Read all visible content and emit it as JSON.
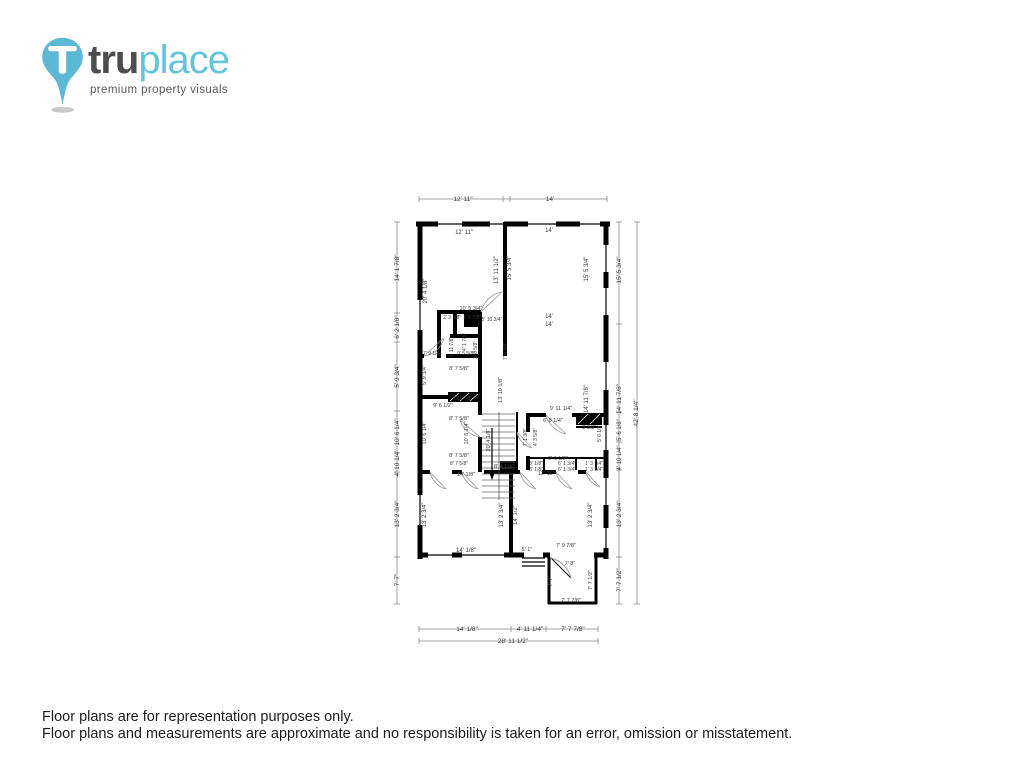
{
  "logo": {
    "brand_bold": "tru",
    "brand_light": "place",
    "tagline": "premium property visuals",
    "pin_color": "#5cb8d5",
    "text_dark": "#4d4d4f",
    "text_light": "#66c3dc"
  },
  "footer": {
    "line1": "Floor plans are for representation purposes only.",
    "line2": "Floor plans and measurements are approximate and no responsibility is taken for an error, omission or misstatement."
  },
  "floorplan": {
    "wall_color": "#000000",
    "dimline_color": "#777777",
    "overall_width": "28' 11 1/2\"",
    "overall_height": "42' 8 1/4\"",
    "labels": [
      {
        "t": "12' 11\"",
        "x": 463,
        "y": 201,
        "r": 0,
        "s": 6.5
      },
      {
        "t": "14'",
        "x": 550,
        "y": 201,
        "r": 0,
        "s": 6.5
      },
      {
        "t": "12' 11\"",
        "x": 464,
        "y": 234,
        "r": 0,
        "s": 6
      },
      {
        "t": "14'",
        "x": 549,
        "y": 232,
        "r": 0,
        "s": 6
      },
      {
        "t": "14' 1 7/8\"",
        "x": 399,
        "y": 268,
        "r": -90,
        "s": 6.5
      },
      {
        "t": "6' 2 1/8\"",
        "x": 399,
        "y": 327,
        "r": -90,
        "s": 6.5
      },
      {
        "t": "5' 9 3/4\"",
        "x": 399,
        "y": 376,
        "r": -90,
        "s": 6.5
      },
      {
        "t": "10' 6 1/4\"",
        "x": 399,
        "y": 432,
        "r": -90,
        "s": 6.5
      },
      {
        "t": "4' 10 1/4\"",
        "x": 399,
        "y": 463,
        "r": -90,
        "s": 6.5
      },
      {
        "t": "13' 2 3/4\"",
        "x": 399,
        "y": 514,
        "r": -90,
        "s": 6.5
      },
      {
        "t": "7' 7\"",
        "x": 399,
        "y": 580,
        "r": -90,
        "s": 6.5
      },
      {
        "t": "20' 4 1/8\"",
        "x": 427,
        "y": 291,
        "r": -90,
        "s": 6
      },
      {
        "t": "13' 11 1/2\"",
        "x": 498,
        "y": 270,
        "r": -90,
        "s": 6
      },
      {
        "t": "15' 5 3/4\"",
        "x": 511,
        "y": 268,
        "r": -90,
        "s": 6
      },
      {
        "t": "15' 5 3/4\"",
        "x": 588,
        "y": 269,
        "r": -90,
        "s": 6
      },
      {
        "t": "15' 5 3/4\"",
        "x": 621,
        "y": 270,
        "r": -90,
        "s": 6.5
      },
      {
        "t": "42' 8 1/4\"",
        "x": 638,
        "y": 413,
        "r": -90,
        "s": 6.5
      },
      {
        "t": "14'",
        "x": 549,
        "y": 318,
        "r": 0,
        "s": 6
      },
      {
        "t": "14'",
        "x": 549,
        "y": 326,
        "r": 0,
        "s": 6
      },
      {
        "t": "14' 11 7/8\"",
        "x": 588,
        "y": 399,
        "r": -90,
        "s": 6
      },
      {
        "t": "14' 11 7/8\"",
        "x": 621,
        "y": 399,
        "r": -90,
        "s": 6.5
      },
      {
        "t": "10' 5 3/4\"",
        "x": 471,
        "y": 310,
        "r": 0,
        "s": 5.5
      },
      {
        "t": "2' 3 3/8\"",
        "x": 452,
        "y": 319,
        "r": 0,
        "s": 5
      },
      {
        "t": "1' 5 7/8\"",
        "x": 472,
        "y": 319,
        "r": 0,
        "s": 5
      },
      {
        "t": "5' 10 3/4\"",
        "x": 492,
        "y": 321,
        "r": 0,
        "s": 5
      },
      {
        "t": "6' 4 5/8\"",
        "x": 441,
        "y": 347,
        "r": -90,
        "s": 5
      },
      {
        "t": "3' 11 7/8\"",
        "x": 453,
        "y": 347,
        "r": -90,
        "s": 5
      },
      {
        "t": "4' 1 7/8\"",
        "x": 466,
        "y": 342,
        "r": -90,
        "s": 5
      },
      {
        "t": "3' 8 5/8\"",
        "x": 477,
        "y": 350,
        "r": -90,
        "s": 5
      },
      {
        "t": "7' 8 5/8\"",
        "x": 507,
        "y": 351,
        "r": -90,
        "s": 5
      },
      {
        "t": "7' 9 1/4\"",
        "x": 432,
        "y": 355,
        "r": 0,
        "s": 5
      },
      {
        "t": "9' 5 5/8\"",
        "x": 466,
        "y": 355,
        "r": 0,
        "s": 5
      },
      {
        "t": "8' 7 5/8\"",
        "x": 459,
        "y": 370,
        "r": 0,
        "s": 5.5
      },
      {
        "t": "5' 9 3/4\"",
        "x": 426,
        "y": 375,
        "r": -90,
        "s": 5.5
      },
      {
        "t": "13' 10 1/8\"",
        "x": 502,
        "y": 390,
        "r": -90,
        "s": 5.5
      },
      {
        "t": "2' 11 7/8\"",
        "x": 462,
        "y": 400,
        "r": 0,
        "s": 5
      },
      {
        "t": "9' 6 1/2\"",
        "x": 443,
        "y": 407,
        "r": 0,
        "s": 5.5
      },
      {
        "t": "8' 7 5/8\"",
        "x": 459,
        "y": 420,
        "r": 0,
        "s": 5.5
      },
      {
        "t": "10' 6 1/4\"",
        "x": 426,
        "y": 433,
        "r": -90,
        "s": 5.5
      },
      {
        "t": "10' 6 1/4\"",
        "x": 468,
        "y": 433,
        "r": -90,
        "s": 5.5
      },
      {
        "t": "20' 4 1/8\"",
        "x": 490,
        "y": 440,
        "r": -90,
        "s": 5.5
      },
      {
        "t": "8' 7 5/8\"",
        "x": 459,
        "y": 457,
        "r": 0,
        "s": 5.5
      },
      {
        "t": "8' 7 5/8\"",
        "x": 459,
        "y": 465,
        "r": 0,
        "s": 5
      },
      {
        "t": "14' 1/8\"",
        "x": 466,
        "y": 476,
        "r": 0,
        "s": 5.5
      },
      {
        "t": "8' 4 1/4\"",
        "x": 504,
        "y": 468,
        "r": 0,
        "s": 5.5
      },
      {
        "t": "12' 11\"",
        "x": 546,
        "y": 475,
        "r": 0,
        "s": 5.5
      },
      {
        "t": "9' 11 1/4\"",
        "x": 561,
        "y": 410,
        "r": 0,
        "s": 5.5
      },
      {
        "t": "6' 8 1/4\"",
        "x": 553,
        "y": 422,
        "r": 0,
        "s": 5.5
      },
      {
        "t": "3' 3/8\"",
        "x": 589,
        "y": 429,
        "r": 0,
        "s": 5
      },
      {
        "t": "7' 1 3/8\"",
        "x": 527,
        "y": 437,
        "r": -90,
        "s": 5
      },
      {
        "t": "4' 3 5/8\"",
        "x": 537,
        "y": 437,
        "r": -90,
        "s": 5
      },
      {
        "t": "5' 6 1/8\"",
        "x": 601,
        "y": 433,
        "r": -90,
        "s": 5
      },
      {
        "t": "9' 6 1/2\"",
        "x": 558,
        "y": 460,
        "r": 0,
        "s": 5.5
      },
      {
        "t": "3' 1/8\"",
        "x": 536,
        "y": 465,
        "r": 0,
        "s": 5
      },
      {
        "t": "3' 1/8\"",
        "x": 536,
        "y": 471,
        "r": 0,
        "s": 5
      },
      {
        "t": "6' 1 3/4\"",
        "x": 567,
        "y": 465,
        "r": 0,
        "s": 5
      },
      {
        "t": "6' 1 3/4\"",
        "x": 567,
        "y": 471,
        "r": 0,
        "s": 5
      },
      {
        "t": "1' 3 1/4\"",
        "x": 594,
        "y": 465,
        "r": 0,
        "s": 5
      },
      {
        "t": "1' 3 1/4\"",
        "x": 594,
        "y": 471,
        "r": 0,
        "s": 5
      },
      {
        "t": "5' 6 1/8\"",
        "x": 621,
        "y": 430,
        "r": -90,
        "s": 6
      },
      {
        "t": "4' 10 1/4\"",
        "x": 621,
        "y": 458,
        "r": -90,
        "s": 6
      },
      {
        "t": "13' 2 3/4\"",
        "x": 621,
        "y": 514,
        "r": -90,
        "s": 6.5
      },
      {
        "t": "7' 7 1/2\"",
        "x": 621,
        "y": 580,
        "r": -90,
        "s": 6.5
      },
      {
        "t": "13' 2 3/4\"",
        "x": 426,
        "y": 515,
        "r": -90,
        "s": 6
      },
      {
        "t": "13' 2 3/4\"",
        "x": 503,
        "y": 515,
        "r": -90,
        "s": 6
      },
      {
        "t": "14' 1/2\"",
        "x": 517,
        "y": 515,
        "r": -90,
        "s": 6
      },
      {
        "t": "13' 2 3/4\"",
        "x": 592,
        "y": 515,
        "r": -90,
        "s": 6
      },
      {
        "t": "14' 1/8\"",
        "x": 466,
        "y": 552,
        "r": 0,
        "s": 6
      },
      {
        "t": "5' 1\"",
        "x": 527,
        "y": 551,
        "r": 0,
        "s": 5.5
      },
      {
        "t": "7' 9 7/8\"",
        "x": 566,
        "y": 547,
        "r": 0,
        "s": 5.5
      },
      {
        "t": "7' 8\"",
        "x": 570,
        "y": 565,
        "r": 0,
        "s": 5.5
      },
      {
        "t": "7' 7\"",
        "x": 552,
        "y": 581,
        "r": -90,
        "s": 5.5
      },
      {
        "t": "7' 7 1/2\"",
        "x": 592,
        "y": 580,
        "r": -90,
        "s": 5.5
      },
      {
        "t": "7' 7 7/8\"",
        "x": 571,
        "y": 602,
        "r": 0,
        "s": 5.5
      },
      {
        "t": "14' 1/8\"",
        "x": 467,
        "y": 631,
        "r": 0,
        "s": 6.5
      },
      {
        "t": "4' 11 1/4\"",
        "x": 530,
        "y": 631,
        "r": 0,
        "s": 6.5
      },
      {
        "t": "7' 7 7/8\"",
        "x": 573,
        "y": 631,
        "r": 0,
        "s": 6.5
      },
      {
        "t": "28' 11 1/2\"",
        "x": 513,
        "y": 643,
        "r": 0,
        "s": 6.5
      }
    ]
  }
}
